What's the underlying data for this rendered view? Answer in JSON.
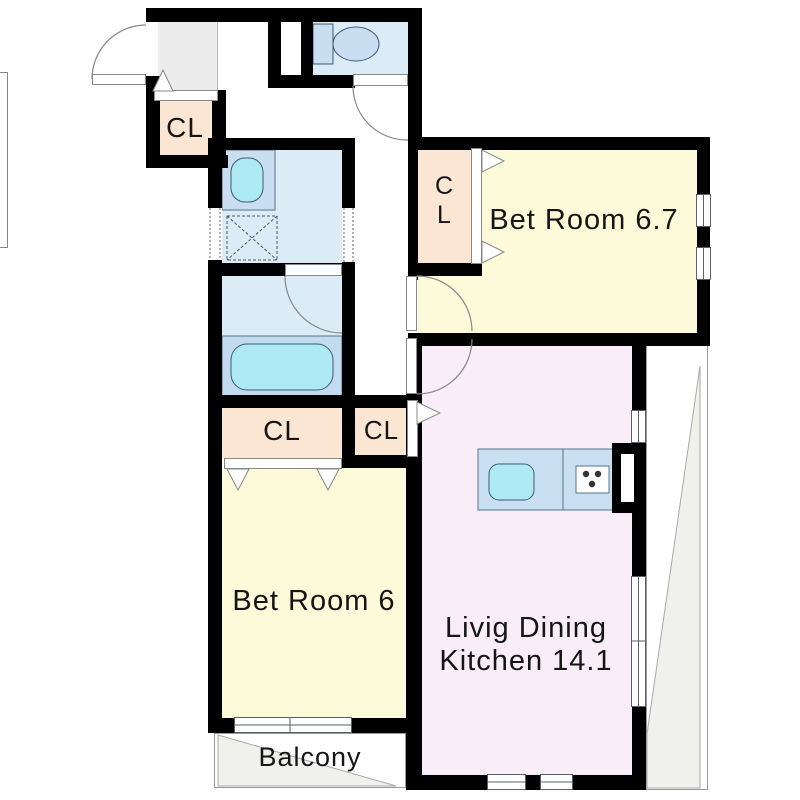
{
  "plan": {
    "type": "apartment-floor-plan",
    "rooms": {
      "bedroom_1": {
        "label": "Bet Room 6.7",
        "color": "#fcfad8"
      },
      "bedroom_2": {
        "label": "Bet Room 6",
        "color": "#fcfad8"
      },
      "ldk": {
        "label_line_1": "Livig Dining",
        "label_line_2": "Kitchen 14.1",
        "color": "#f9eef8"
      },
      "balcony": {
        "label": "Balcony"
      },
      "entrance_closet": {
        "label": "CL"
      },
      "bedroom_1_closet": {
        "label_line_1": "C",
        "label_line_2": "L"
      },
      "bedroom_2_closet": {
        "label": "CL"
      },
      "hall_closet": {
        "label": "CL"
      }
    },
    "colors": {
      "wall": "#000000",
      "room_yellow": "#fcfad8",
      "room_pink": "#f9eef8",
      "closet_peach": "#fbe5d3",
      "wet_area_blue": "#dcecf7",
      "fixture_cyan": "#aeeaf3",
      "counter_blue": "#c9dff2",
      "entrance_gray": "#ececec",
      "outdoor_gray": "#f0f0ed"
    }
  }
}
